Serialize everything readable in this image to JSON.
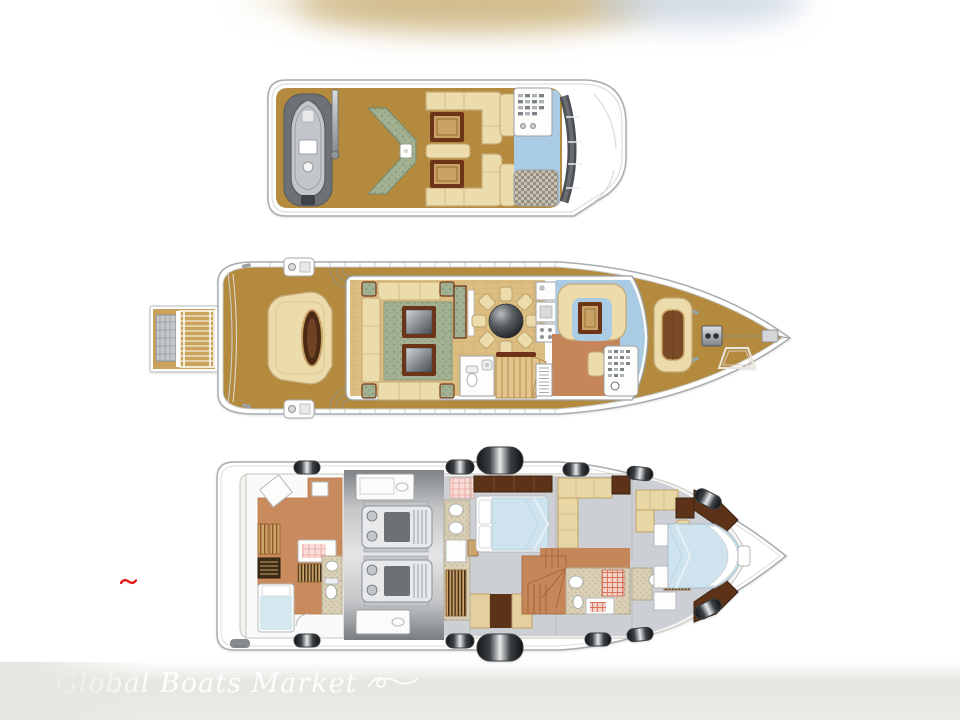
{
  "page": {
    "type": "yacht-deck-plan-diagram",
    "orientation": "bow-right",
    "background": "#ffffff"
  },
  "watermark": {
    "text": "Global Boats Market",
    "style": "white script lettering with swirl ornament on grey band"
  },
  "marks": {
    "red_dash": "small red squiggle left of lower deck plan"
  },
  "decks": [
    {
      "name": "flybridge-sun-deck",
      "position": "top",
      "features": [
        "tender-on-cradle",
        "launch-crane",
        "chevron-wet-bar-with-sink",
        "forward-dinette-with-table",
        "aft-dinette-with-table",
        "helm-console",
        "spa-blue-area",
        "woven-sun-pad",
        "windshield-arc"
      ]
    },
    {
      "name": "main-deck",
      "position": "middle",
      "features": [
        "swim-platform-with-ladder",
        "aft-deck-lounge-with-oval-table",
        "mooring-winches",
        "salon-u-sofa-with-green-rug",
        "twin-coffee-tables",
        "round-dining-table-eight-chairs",
        "sideboard",
        "appliance-column",
        "day-head",
        "staircase-down",
        "galley-terracotta",
        "pilothouse-settee-and-table",
        "helm-station",
        "foredeck-sun-pad",
        "anchor-windlass",
        "anchor-chain",
        "foredeck-hatch"
      ]
    },
    {
      "name": "lower-deck",
      "position": "bottom",
      "portholes": 12,
      "features": [
        "crew-cabin-with-bunks",
        "crew-single-berth",
        "crew-bathroom",
        "engine-room-twin-engines",
        "full-beam-master-cabin",
        "master-ensuite-twin-sinks",
        "amidships-staircase",
        "port-guest-cabin-sofa",
        "guest-bathroom",
        "starboard-guest-cabin-desk",
        "forward-vip-cabin-island-berth"
      ]
    }
  ],
  "colors": {
    "deck_teak": "#b48a3e",
    "hull_white": "#ffffff",
    "outline_grey": "#a7acb0",
    "upholstery_cream": "#ecdcab",
    "table_wood_dark": "#6e3418",
    "table_wood_light": "#c9a365",
    "rug_green": "#a3b193",
    "water_blue": "#a9cbe4",
    "duvet_blue": "#cfe3ee",
    "galley_terracotta": "#c5875a",
    "crew_terracotta": "#c98a5e",
    "cabin_carpet_grey": "#ccd0d4",
    "wardrobe_brown": "#5c3318",
    "porthole_dark": "#141618",
    "accent_red": "#e01818",
    "watermark_band": "#e8e6e2"
  }
}
